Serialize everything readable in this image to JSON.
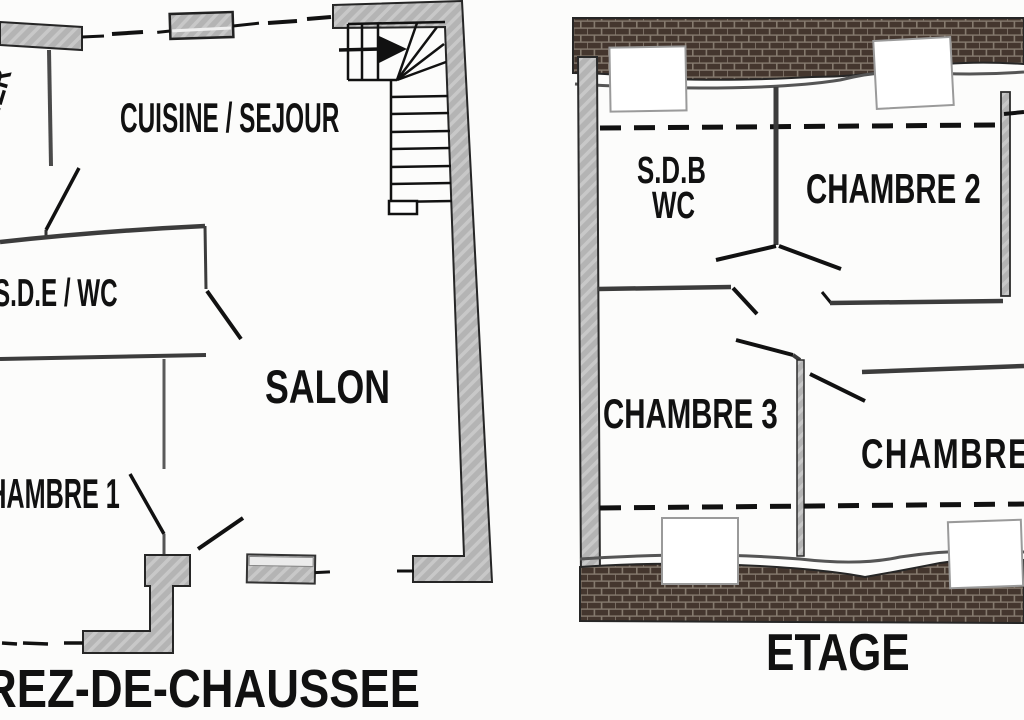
{
  "document": {
    "kind": "architectural floor plan, two levels side by side"
  },
  "ground_floor": {
    "title": "REZ-DE-CHAUSSEE",
    "rooms": {
      "cellier": "CELLIER",
      "cuisine_sejour": "CUISINE / SEJOUR",
      "sde_wc": "S.D.E / WC",
      "salon": "SALON",
      "chambre1": "CHAMBRE 1"
    }
  },
  "upper_floor": {
    "title": "ETAGE",
    "rooms": {
      "sdb": "S.D.B",
      "wc": "WC",
      "chambre2": "CHAMBRE 2",
      "chambre3": "CHAMBRE 3",
      "chambre4": "CHAMBRE"
    }
  },
  "icons": {
    "stair_direction_arrow": "right-arrow"
  },
  "colors": {
    "wall_gray": "#b4b4b4",
    "wall_streak": "#c8c8c8",
    "brick": "#44362e",
    "mortar": "#857a6e",
    "line_ink": "#111111",
    "paper": "#fcfcfb"
  }
}
